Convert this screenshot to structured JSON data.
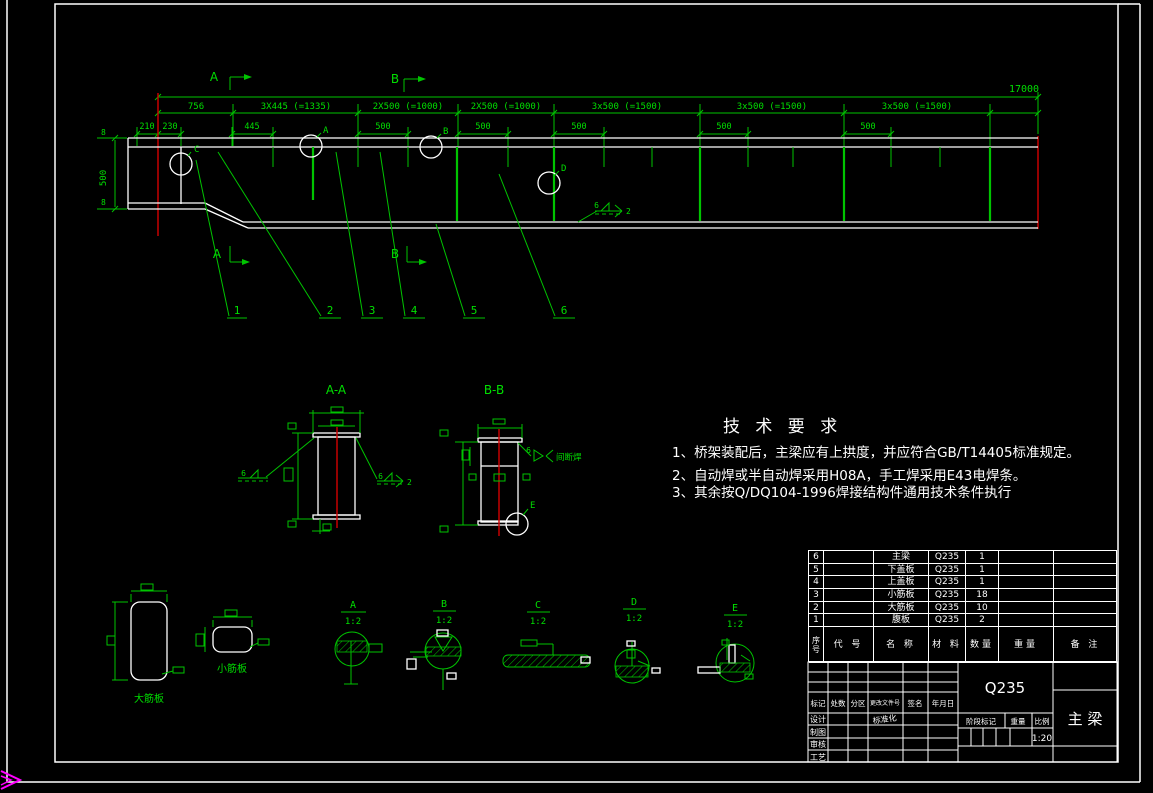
{
  "colors": {
    "background": "#000000",
    "line_green": "#00C400",
    "text_green": "#00DF00",
    "drawing_white": "#FFFFFF",
    "datum_red": "#D40000",
    "mark_magenta": "#FF00FF"
  },
  "main_view": {
    "total_dim": "17000",
    "segment_dims": [
      "756",
      "3X445 (=1335)",
      "2X500 (=1000)",
      "2X500 (=1000)",
      "3x500 (=1500)",
      "3x500 (=1500)",
      "3x500 (=1500)"
    ],
    "sub_dims": [
      "210",
      "230",
      "445",
      "500",
      "500",
      "500",
      "500",
      "500"
    ],
    "left_height_dim": "500",
    "thickness_marks": [
      "8",
      "8"
    ],
    "section_marks": {
      "a": "A",
      "b": "B"
    },
    "detail_markers": {
      "a": "A",
      "b": "B",
      "c": "C",
      "d": "D"
    },
    "part_numbers": [
      "1",
      "2",
      "3",
      "4",
      "5",
      "6"
    ],
    "weld_note": {
      "size": "6",
      "tail": "2"
    }
  },
  "sections": {
    "aa": {
      "title": "A-A",
      "weld_left": "6",
      "weld_right": "6",
      "weld_right_tail": "2"
    },
    "bb": {
      "title": "B-B",
      "weld_size": "6",
      "weld_text": "间断焊",
      "detail_marker": "E"
    }
  },
  "plates": {
    "large_label": "大筋板",
    "small_label": "小筋板"
  },
  "details": [
    {
      "label": "A",
      "scale": "1:2"
    },
    {
      "label": "B",
      "scale": "1:2"
    },
    {
      "label": "C",
      "scale": "1:2"
    },
    {
      "label": "D",
      "scale": "1:2"
    },
    {
      "label": "E",
      "scale": "1:2"
    }
  ],
  "tech_req": {
    "title": "技 术 要 求",
    "items": [
      "1、桥架装配后，主梁应有上拱度，并应符合GB/T14405标准规定。",
      "2、自动焊或半自动焊采用H08A，手工焊采用E43电焊条。",
      "3、其余按Q/DQ104-1996焊接结构件通用技术条件执行"
    ]
  },
  "bom": {
    "headers": {
      "seq": "序号",
      "code": "代 号",
      "name": "名 称",
      "material": "材 料",
      "qty": "数量",
      "weight": "重量",
      "remark": "备 注"
    },
    "rows": [
      {
        "num": "6",
        "name": "主梁",
        "material": "Q235",
        "qty": "1"
      },
      {
        "num": "5",
        "name": "下盖板",
        "material": "Q235",
        "qty": "1"
      },
      {
        "num": "4",
        "name": "上盖板",
        "material": "Q235",
        "qty": "1"
      },
      {
        "num": "3",
        "name": "小筋板",
        "material": "Q235",
        "qty": "18"
      },
      {
        "num": "2",
        "name": "大筋板",
        "material": "Q235",
        "qty": "10"
      },
      {
        "num": "1",
        "name": "腹板",
        "material": "Q235",
        "qty": "2"
      }
    ]
  },
  "title_block": {
    "rev_headers": [
      "标记",
      "处数",
      "分区",
      "更改文件号",
      "签名",
      "年月日"
    ],
    "roles": [
      "设计",
      "制图",
      "审核",
      "工艺"
    ],
    "standardization": "标准化",
    "material": "Q235",
    "drawing_title": "主 梁",
    "stage_label": "阶段标记",
    "weight_label": "重量",
    "scale_label": "比例",
    "scale_value": "1:20"
  }
}
